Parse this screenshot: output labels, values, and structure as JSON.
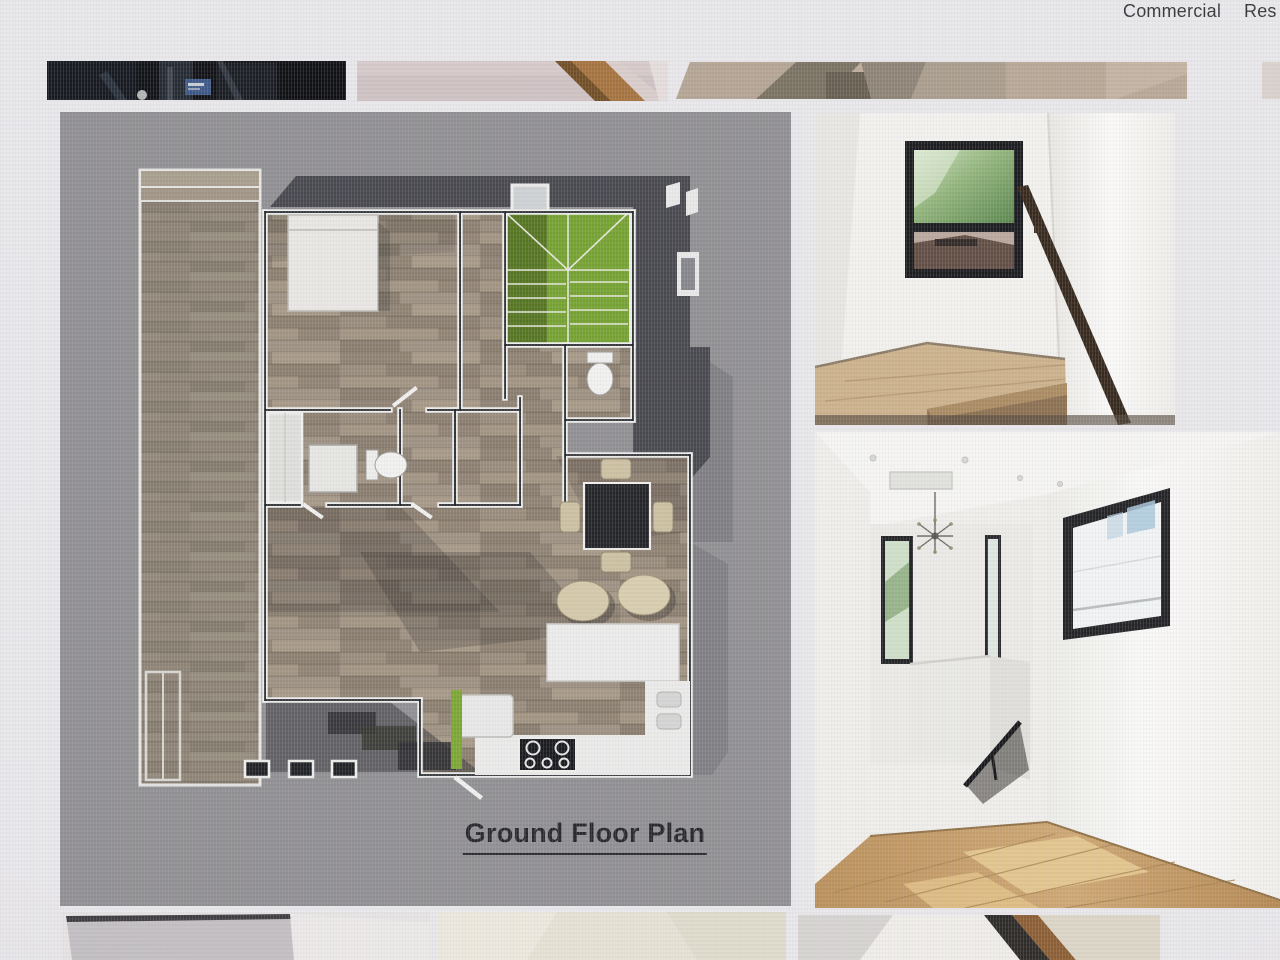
{
  "nav": {
    "items": [
      {
        "id": "commercial",
        "label": "Commercial"
      },
      {
        "id": "residential",
        "label": "Res"
      }
    ]
  },
  "gallery": {
    "floor_plan": {
      "caption": "Ground Floor Plan"
    },
    "photos": [
      {
        "id": "stairwell-landing-photo"
      },
      {
        "id": "upstairs-hallway-photo"
      }
    ],
    "top_thumbnails": [
      {
        "id": "dark-interior-thumbnail"
      },
      {
        "id": "stair-corner-thumbnail"
      },
      {
        "id": "stair-strip-thumbnail"
      },
      {
        "id": "edge-fragment-thumbnail"
      }
    ],
    "bottom_thumbnails": [
      {
        "id": "wall-corner-thumbnail"
      },
      {
        "id": "cream-interior-thumbnail"
      },
      {
        "id": "stair-beam-thumbnail"
      }
    ]
  },
  "colors": {
    "page_bg": "#e9e8ea",
    "plan_bg": "#8f8e91",
    "plan_roof_gray": "#45464b",
    "plan_wall_white": "#eef0ee",
    "plan_wall_core": "#1a1d20",
    "plan_stair_green": "#73a12e",
    "plan_wood": "#9a8e7e",
    "photo_floor_wood": "#c69e66",
    "caption_color": "#232528"
  }
}
